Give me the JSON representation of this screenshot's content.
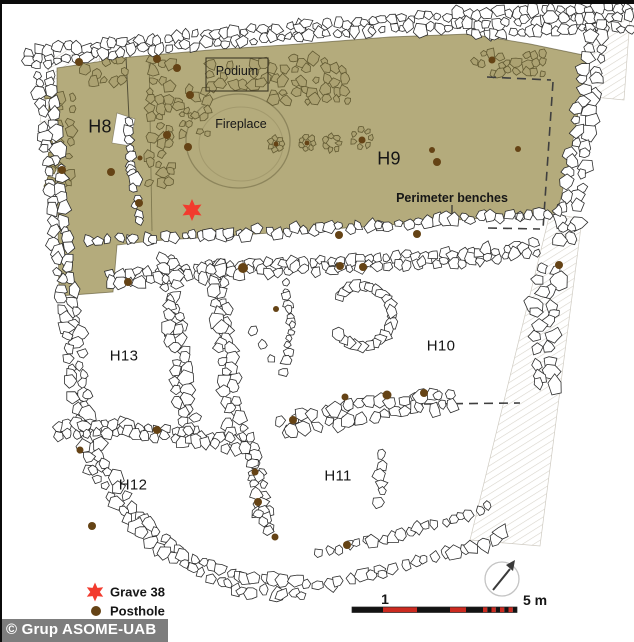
{
  "figure": {
    "watermark": "© Grup ASOME-UAB"
  },
  "colors": {
    "floor_shade": "#b4ab7c",
    "stone_fill": "#ffffff",
    "stone_stroke": "#2d2d2d",
    "tinted_stone_fill": "#aca272",
    "tinted_stone_stroke": "#625a33",
    "posthole": "#654315",
    "grave_star": "#f23b2e",
    "scale_red": "#cc2a20",
    "scale_black": "#131313",
    "dash_line": "#3f3f3f",
    "hatch_line": "#d8d4cb",
    "fireplace_outline": "#8d855c"
  },
  "rooms": [
    {
      "id": "H8",
      "x": 100,
      "y": 127
    },
    {
      "id": "H9",
      "x": 389,
      "y": 159
    },
    {
      "id": "H10",
      "x": 441,
      "y": 346
    },
    {
      "id": "H11",
      "x": 338,
      "y": 476
    },
    {
      "id": "H12",
      "x": 133,
      "y": 485
    },
    {
      "id": "H13",
      "x": 124,
      "y": 356
    }
  ],
  "features": [
    {
      "label": "Podium",
      "x": 237,
      "y": 71
    },
    {
      "label": "Fireplace",
      "x": 241,
      "y": 124
    },
    {
      "label": "Perimeter benches",
      "x": 452,
      "y": 198
    }
  ],
  "legend": {
    "items": [
      {
        "symbol": "grave-star",
        "label": "Grave 38",
        "x": 110,
        "y": 592
      },
      {
        "symbol": "posthole-dot",
        "label": "Posthole",
        "x": 110,
        "y": 611
      }
    ]
  },
  "scale_bar": {
    "tick_label": "1",
    "end_label": "5 m",
    "tick_x": 385,
    "tick_y": 599,
    "end_x": 535,
    "end_y": 600
  },
  "grave": {
    "x": 192,
    "y": 210
  },
  "postholes": [
    [
      62,
      170,
      4
    ],
    [
      111,
      172,
      4
    ],
    [
      79,
      62,
      4
    ],
    [
      157,
      59,
      4
    ],
    [
      177,
      68,
      4
    ],
    [
      190,
      95,
      4
    ],
    [
      167,
      135,
      4
    ],
    [
      188,
      147,
      4
    ],
    [
      139,
      203,
      4
    ],
    [
      193,
      208,
      3
    ],
    [
      140,
      158,
      2.5
    ],
    [
      276,
      144,
      2.5
    ],
    [
      307,
      143,
      2.5
    ],
    [
      362,
      140,
      3.5
    ],
    [
      432,
      150,
      3
    ],
    [
      437,
      162,
      4
    ],
    [
      518,
      149,
      3
    ],
    [
      492,
      60,
      3.5
    ],
    [
      339,
      235,
      4
    ],
    [
      417,
      234,
      4
    ],
    [
      243,
      268,
      5
    ],
    [
      340,
      266,
      4
    ],
    [
      363,
      267,
      4
    ],
    [
      559,
      265,
      4
    ],
    [
      128,
      282,
      4
    ],
    [
      157,
      430,
      4
    ],
    [
      276,
      309,
      3
    ],
    [
      293,
      420,
      4
    ],
    [
      80,
      450,
      3.5
    ],
    [
      92,
      526,
      4
    ],
    [
      255,
      472,
      3.5
    ],
    [
      258,
      502,
      4
    ],
    [
      275,
      537,
      3.5
    ],
    [
      347,
      545,
      4
    ],
    [
      345,
      397,
      3.5
    ],
    [
      387,
      395,
      4.5
    ],
    [
      424,
      393,
      4
    ]
  ]
}
